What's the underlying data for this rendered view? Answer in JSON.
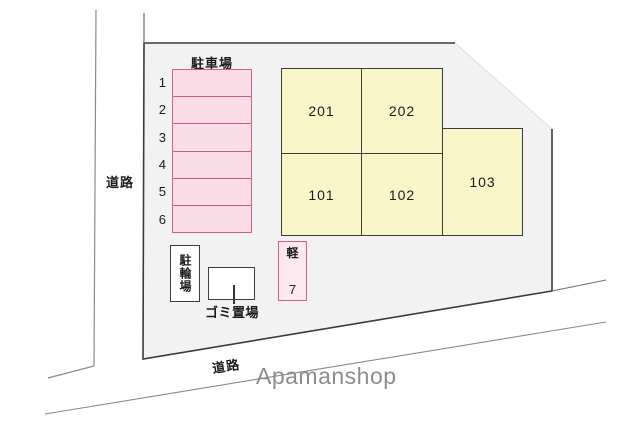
{
  "colors": {
    "plot-fill": "#f2f2f3",
    "boundary": "#3b3b3b",
    "road-line": "#8a8a8a",
    "pink-fill": "#fbdde7",
    "pink-border": "#d4607f",
    "pink-divider": "#cc5a76",
    "kei-fill": "#fce8ef",
    "yellow-fill": "#faf5c9",
    "watermark-gray": "#8c8c8c",
    "text": "#1c1c1c"
  },
  "roads": {
    "left_label": "道路",
    "bottom_label": "道路"
  },
  "parking": {
    "title": "駐車場",
    "spaces": [
      "1",
      "2",
      "3",
      "4",
      "5",
      "6"
    ]
  },
  "units": [
    {
      "id": "201"
    },
    {
      "id": "202"
    },
    {
      "id": "101"
    },
    {
      "id": "102"
    },
    {
      "id": "103"
    }
  ],
  "kei_parking": {
    "label": "軽",
    "number": "7"
  },
  "bicycle_parking": {
    "label": "駐輪場"
  },
  "garbage": {
    "label": "ゴミ置場"
  },
  "watermark": "Apamanshop"
}
